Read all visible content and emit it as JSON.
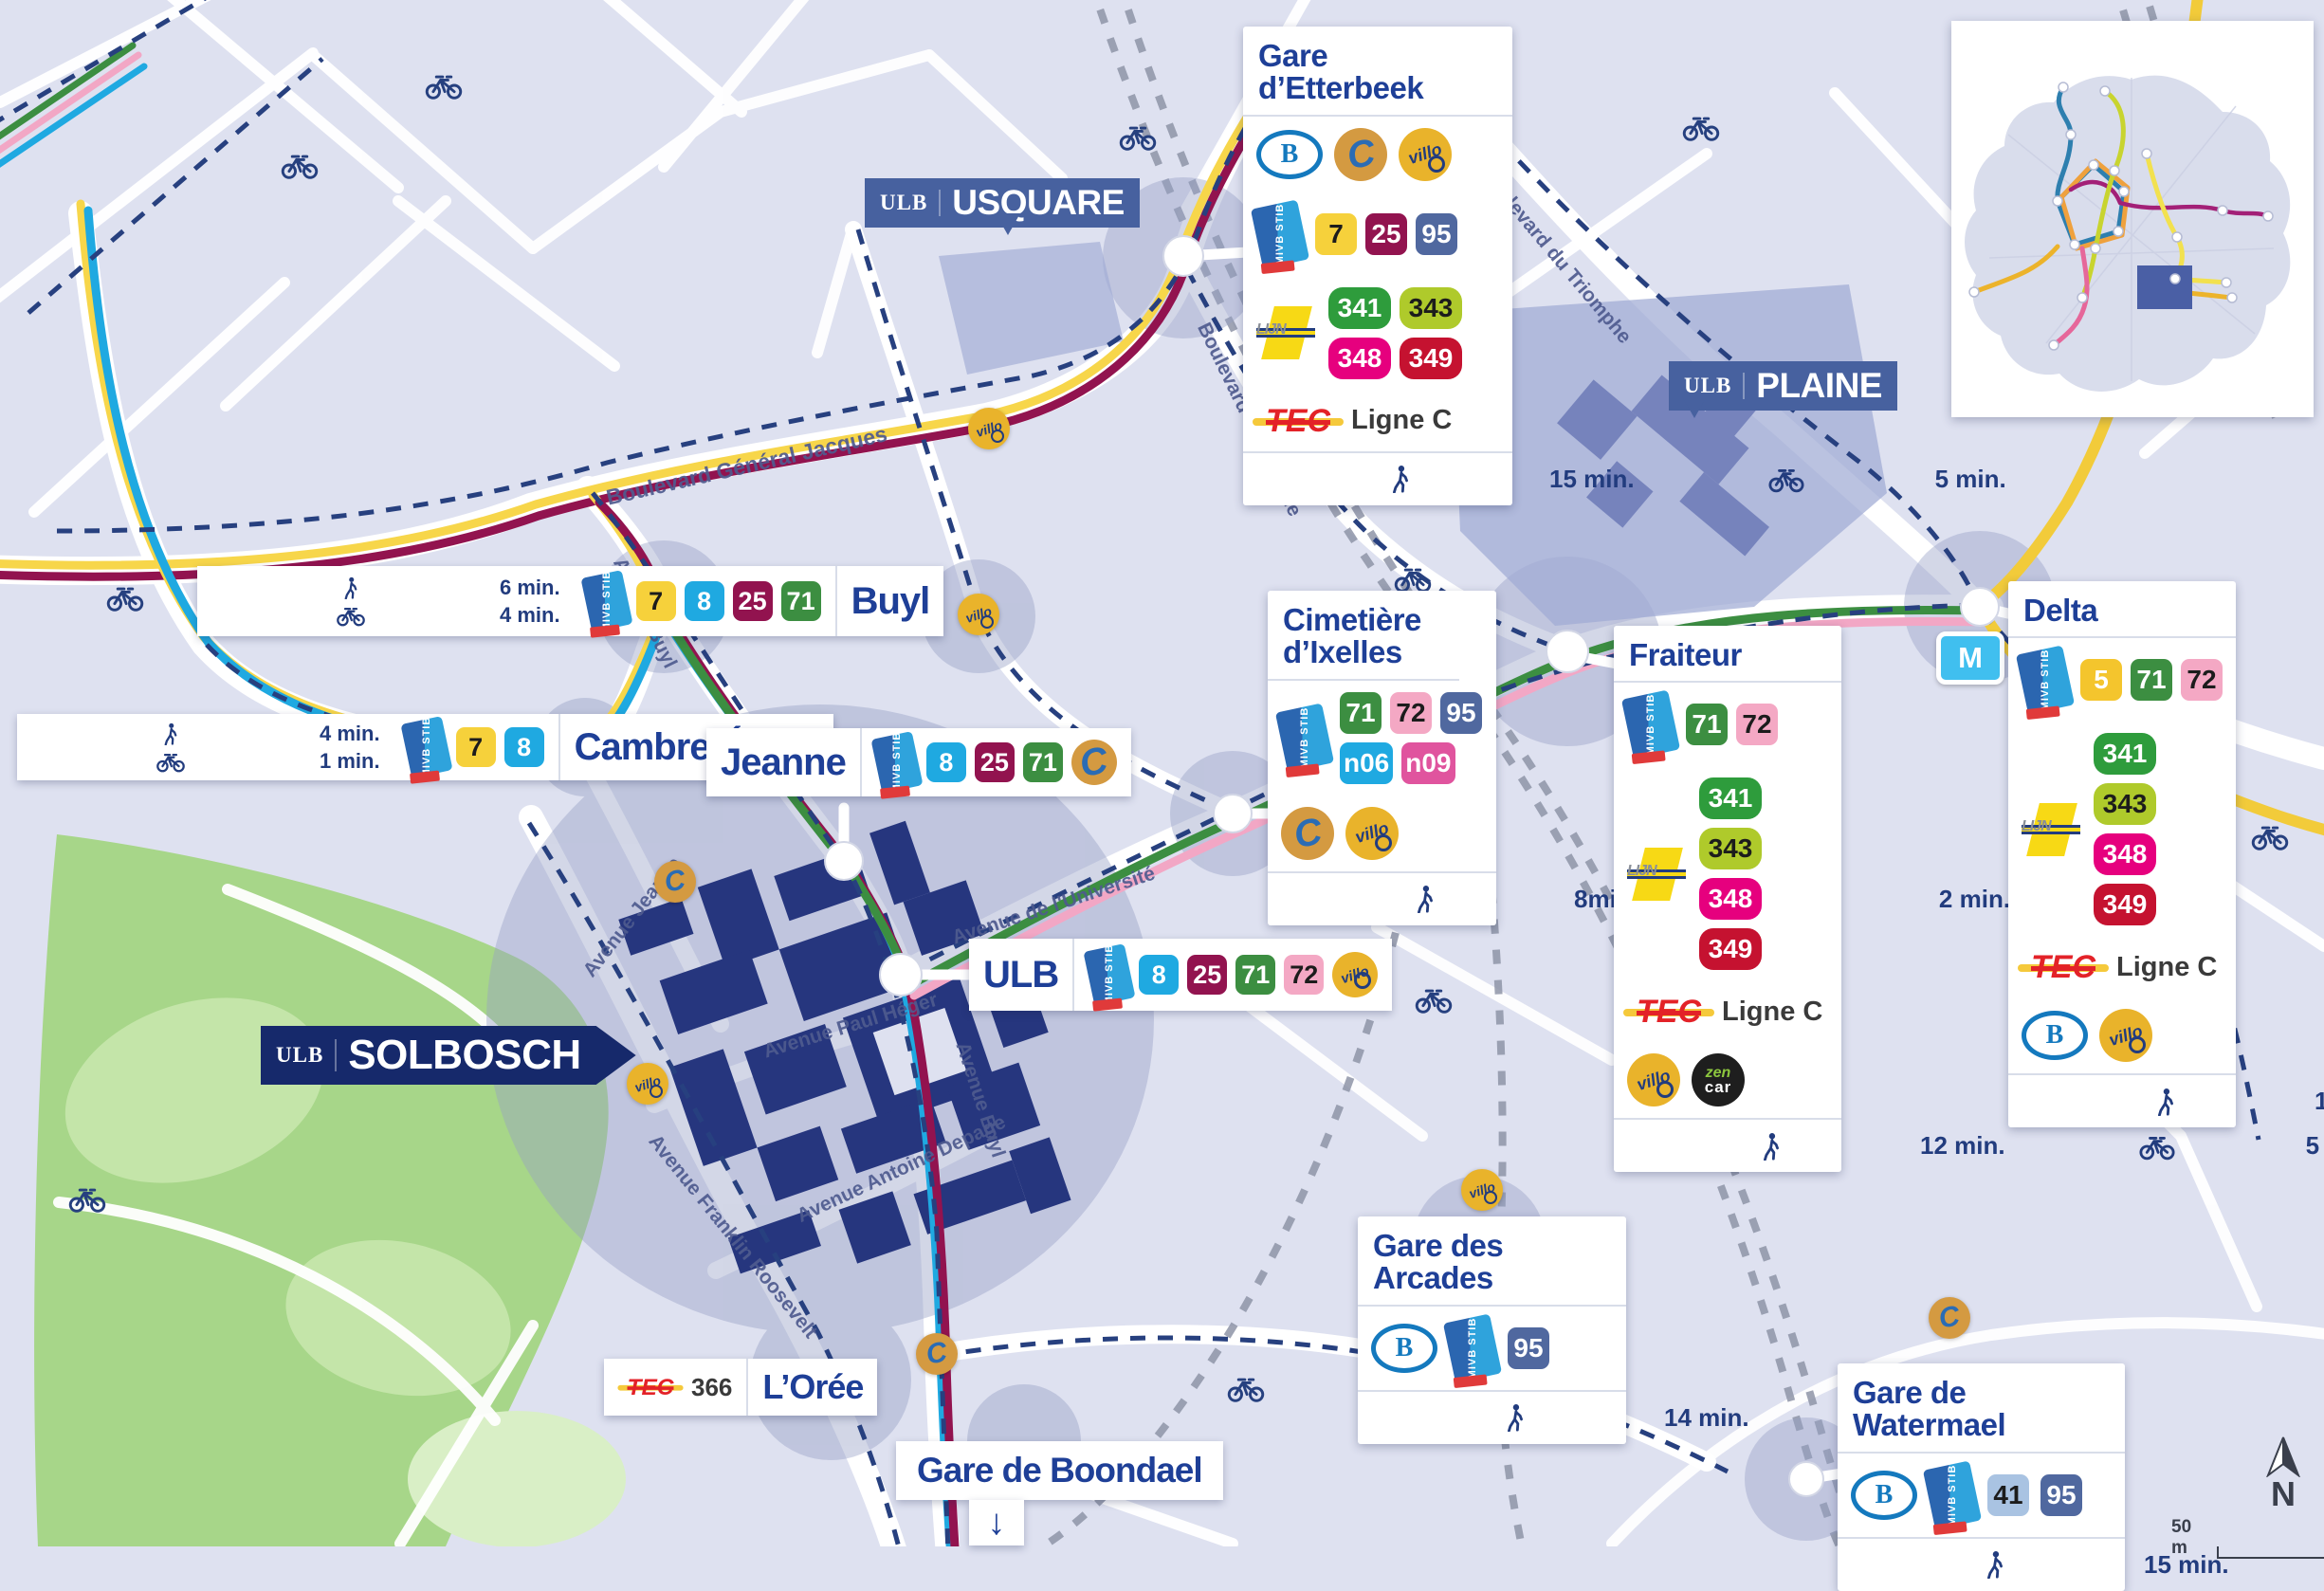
{
  "icons": {
    "stib": {
      "label": "MIVB STIB"
    },
    "sncb": {
      "letter": "B"
    },
    "delijn": {
      "label": "LIJN"
    },
    "tec": {
      "label": "TEC"
    },
    "cambio": {
      "letter": "C"
    },
    "villo": {
      "label": "villo"
    },
    "zencar": {
      "line1": "zen",
      "line2": "car"
    },
    "metro": {
      "letter": "M"
    }
  },
  "compass": {
    "north": "N",
    "scale": "50 m"
  },
  "flags": {
    "usquare": {
      "org": "ULB",
      "name": "USQUARE"
    },
    "plaine": {
      "org": "ULB",
      "name": "PLAINE"
    },
    "solbosch": {
      "org": "ULB",
      "name": "SOLBOSCH"
    }
  },
  "streets": {
    "jacques": "Boulevard Général Jacques",
    "buyl1": "Avenue Buyl",
    "buyl2": "Avenue Buyl",
    "universite": "Avenue de l'Université",
    "plaine_bd": "Boulevard de la Plaine",
    "triomphe": "Boulevard du Triomphe",
    "jeanne": "Avenue Jeanne",
    "heger": "Avenue Paul Héger",
    "roosevelt": "Avenue Franklin Roosevelt",
    "depage": "Avenue Antoine Depage"
  },
  "panels": {
    "etterbeek": {
      "title": "Gare d’Etterbeek",
      "stib": [
        "7",
        "25",
        "95"
      ],
      "delijn": [
        "341",
        "343",
        "348",
        "349"
      ],
      "tec": "Ligne C",
      "walk": "15 min.",
      "bike": "5 min."
    },
    "cimetiere": {
      "title": "Cimetière d’Ixelles",
      "stib": [
        "71",
        "72",
        "95",
        "n06",
        "n09"
      ],
      "walk": "8min.",
      "bike": "2 min."
    },
    "fraiteur": {
      "title": "Fraiteur",
      "stib": [
        "71",
        "72"
      ],
      "delijn": [
        "341",
        "343",
        "348",
        "349"
      ],
      "tec": "Ligne C",
      "walk": "12 min.",
      "bike": "5 min."
    },
    "delta": {
      "title": "Delta",
      "stib": [
        "5",
        "71",
        "72"
      ],
      "delijn": [
        "341",
        "343",
        "348",
        "349"
      ],
      "tec": "Ligne C",
      "walk": "19 min.",
      "bike": "7 min."
    },
    "arcades": {
      "title": "Gare des Arcades",
      "stib": [
        "95"
      ],
      "walk": "14 min.",
      "bike": "4 min."
    },
    "watermael": {
      "title": "Gare de Watermael",
      "stib": [
        "41",
        "95"
      ],
      "walk": "15 min.",
      "bike": "5 min."
    }
  },
  "stops": {
    "buyl": {
      "name": "Buyl",
      "walk": "6 min.",
      "bike": "4 min.",
      "stib": [
        "7",
        "8",
        "25",
        "71"
      ]
    },
    "cambre": {
      "name": "Cambre-Étoile",
      "walk": "4 min.",
      "bike": "1 min.",
      "stib": [
        "7",
        "8"
      ]
    },
    "jeanne": {
      "name": "Jeanne",
      "stib": [
        "8",
        "25",
        "71"
      ]
    },
    "ulb": {
      "name": "ULB",
      "stib": [
        "8",
        "25",
        "71",
        "72"
      ]
    },
    "oree": {
      "name": "L’Orée",
      "tec_line": "366"
    },
    "boondael": {
      "name": "Gare de Boondael",
      "arrow": "↓"
    }
  },
  "colors": {
    "background": "#DEE1F0",
    "park": "#A7D689",
    "campus_building": "#26367E",
    "title_navy": "#1E3F97",
    "lines": {
      "5": "#F4C52D",
      "7": "#F6D13B",
      "8": "#1FA9E1",
      "25": "#92134F",
      "41": "#A9C3E2",
      "71": "#3C8E41",
      "72": "#F4A8C4",
      "95": "#50689F",
      "n06": "#1FA9E1",
      "n09": "#E0549E",
      "341": "#2E9C3C",
      "343": "#AFCA2B",
      "348": "#E6007E",
      "349": "#C51230"
    }
  }
}
